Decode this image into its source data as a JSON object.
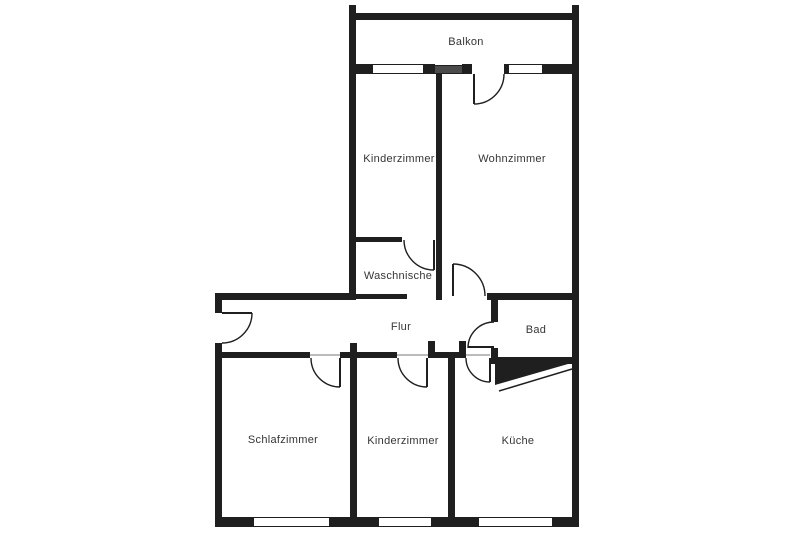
{
  "colors": {
    "wall": "#1f1f1f",
    "background": "#ffffff",
    "label": "#353535",
    "shaded_window": "#4b4b4b"
  },
  "rooms": {
    "balkon": {
      "label": "Balkon"
    },
    "kinderzimmer_top": {
      "label": "Kinderzimmer"
    },
    "wohnzimmer": {
      "label": "Wohnzimmer"
    },
    "waschnische": {
      "label": "Waschnische"
    },
    "flur": {
      "label": "Flur"
    },
    "bad": {
      "label": "Bad"
    },
    "schlafzimmer": {
      "label": "Schlafzimmer"
    },
    "kinderzimmer_bottom": {
      "label": "Kinderzimmer"
    },
    "kueche": {
      "label": "Küche"
    }
  }
}
